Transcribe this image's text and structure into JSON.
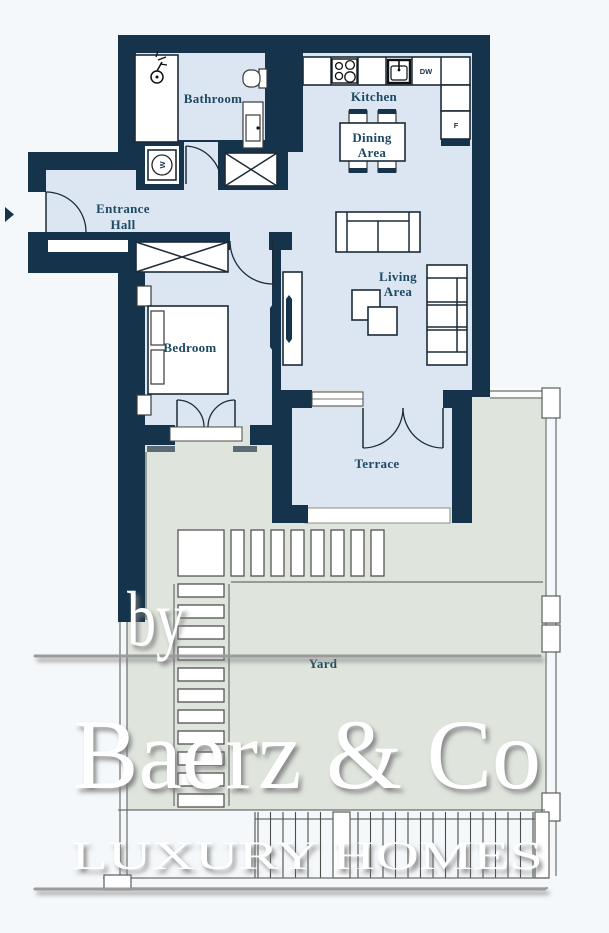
{
  "rooms": {
    "bathroom": "Bathroom",
    "kitchen": "Kitchen",
    "dining_line1": "Dining",
    "dining_line2": "Area",
    "entrance_line1": "Entrance",
    "entrance_line2": "Hall",
    "living_line1": "Living",
    "living_line2": "Area",
    "bedroom": "Bedroom",
    "terrace": "Terrace",
    "yard": "Yard"
  },
  "appliances": {
    "dishwasher": "DW",
    "fridge": "F",
    "washer": "W"
  },
  "watermark": {
    "prefix": "by",
    "brand": "Baerz & Co",
    "tagline": "LUXURY HOMES"
  },
  "colors": {
    "wall": "#15334a",
    "floor": "#dce6f2",
    "yard": "#dfe5dd",
    "label": "#1d4a63"
  }
}
